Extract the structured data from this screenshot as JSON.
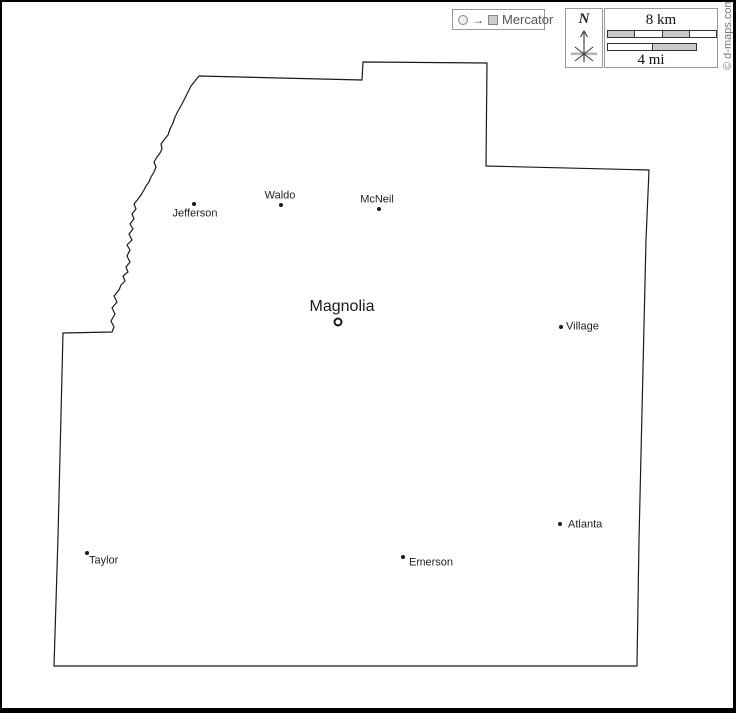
{
  "legend": {
    "projection_label": "Mercator",
    "arrow_glyph": "→"
  },
  "compass": {
    "north_label": "N"
  },
  "scale": {
    "km_label": "8 km",
    "mi_label": "4 mi"
  },
  "credit": {
    "text": "© d-maps.com"
  },
  "colors": {
    "outline": "#1a1a1a",
    "box_border": "#999999",
    "legend_text": "#555555",
    "bar_gray": "#c9c9c9",
    "frame": "#000000"
  },
  "map": {
    "outline_path": "M 199 76 L 362 80 L 363 62 L 487 63 L 486 166 L 649 170 L 646 240 L 639 540 L 637 666 L 54 666 L 58 537 L 63 333 L 112 332 L 114 327 L 111 321 L 115 314 L 112 308 L 117 302 L 114 296 L 119 290 L 121 285 L 125 281 L 123 276 L 128 272 L 126 267 L 130 262 L 127 256 L 130 250 L 127 245 L 132 240 L 129 234 L 133 229 L 130 224 L 134 219 L 132 214 L 136 209 L 134 204 L 138 199 L 141 195 L 144 190 L 146 186 L 149 182 L 151 177 L 154 172 L 156 167 L 154 162 L 157 157 L 160 153 L 162 149 L 161 144 L 164 140 L 168 135 L 170 129 L 173 123 L 175 117 L 178 111 L 182 104 L 185 98 L 188 92 L 191 86 L 195 81 Z",
    "county_seat": {
      "name": "Magnolia"
    },
    "cities": [
      {
        "name": "Jefferson"
      },
      {
        "name": "Waldo"
      },
      {
        "name": "McNeil"
      },
      {
        "name": "Village"
      },
      {
        "name": "Atlanta"
      },
      {
        "name": "Emerson"
      },
      {
        "name": "Taylor"
      }
    ]
  }
}
